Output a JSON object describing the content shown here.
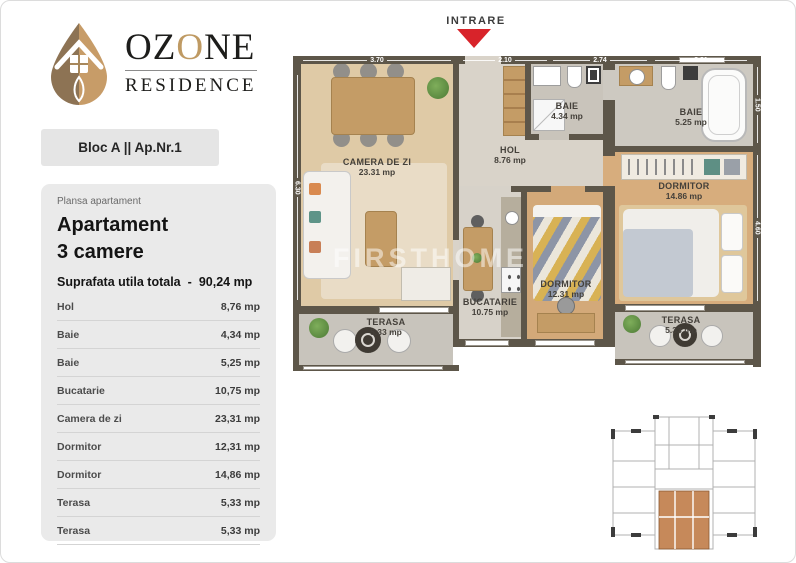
{
  "brand": {
    "word1_pre": "OZ",
    "word1_accent": "O",
    "word1_post": "NE",
    "word2": "RESIDENCE"
  },
  "unit_badge": {
    "label": "Bloc A || Ap.Nr.1"
  },
  "panel": {
    "eyebrow": "Plansa apartament",
    "title_line1": "Apartament",
    "title_line2": "3 camere",
    "total_label": "Suprafata utila totala",
    "total_separator": "-",
    "total_value": "90,24 mp",
    "rows": [
      {
        "label": "Hol",
        "value": "8,76 mp"
      },
      {
        "label": "Baie",
        "value": "4,34 mp"
      },
      {
        "label": "Baie",
        "value": "5,25 mp"
      },
      {
        "label": "Bucatarie",
        "value": "10,75 mp"
      },
      {
        "label": "Camera de zi",
        "value": "23,31 mp"
      },
      {
        "label": "Dormitor",
        "value": "12,31 mp"
      },
      {
        "label": "Dormitor",
        "value": "14,86 mp"
      },
      {
        "label": "Terasa",
        "value": "5,33 mp"
      },
      {
        "label": "Terasa",
        "value": "5,33 mp"
      }
    ]
  },
  "floor_plan": {
    "entrance_label": "INTRARE",
    "watermark": "FIRSTHOME",
    "rooms": [
      {
        "name": "CAMERA DE ZI",
        "area": "23.31 mp"
      },
      {
        "name": "HOL",
        "area": "8.76 mp"
      },
      {
        "name": "BAIE",
        "area": "4.34 mp"
      },
      {
        "name": "BAIE",
        "area": "5.25 mp"
      },
      {
        "name": "DORMITOR",
        "area": "14.86 mp"
      },
      {
        "name": "DORMITOR",
        "area": "12.31 mp"
      },
      {
        "name": "BUCATARIE",
        "area": "10.75 mp"
      },
      {
        "name": "TERASA",
        "area": "5.33 mp"
      },
      {
        "name": "TERASA",
        "area": "5.33 mp"
      }
    ],
    "dimensions": {
      "top": [
        "3.70",
        "2.10",
        "2.74",
        "3.31"
      ],
      "left": [
        "6.30"
      ],
      "right": [
        "1.50",
        "4.60"
      ]
    }
  },
  "colors": {
    "accent-red": "#d8232a",
    "brand-tan": "#bf9a63",
    "wall": "#5d5649",
    "keyplan-highlight": "#c6895a"
  }
}
